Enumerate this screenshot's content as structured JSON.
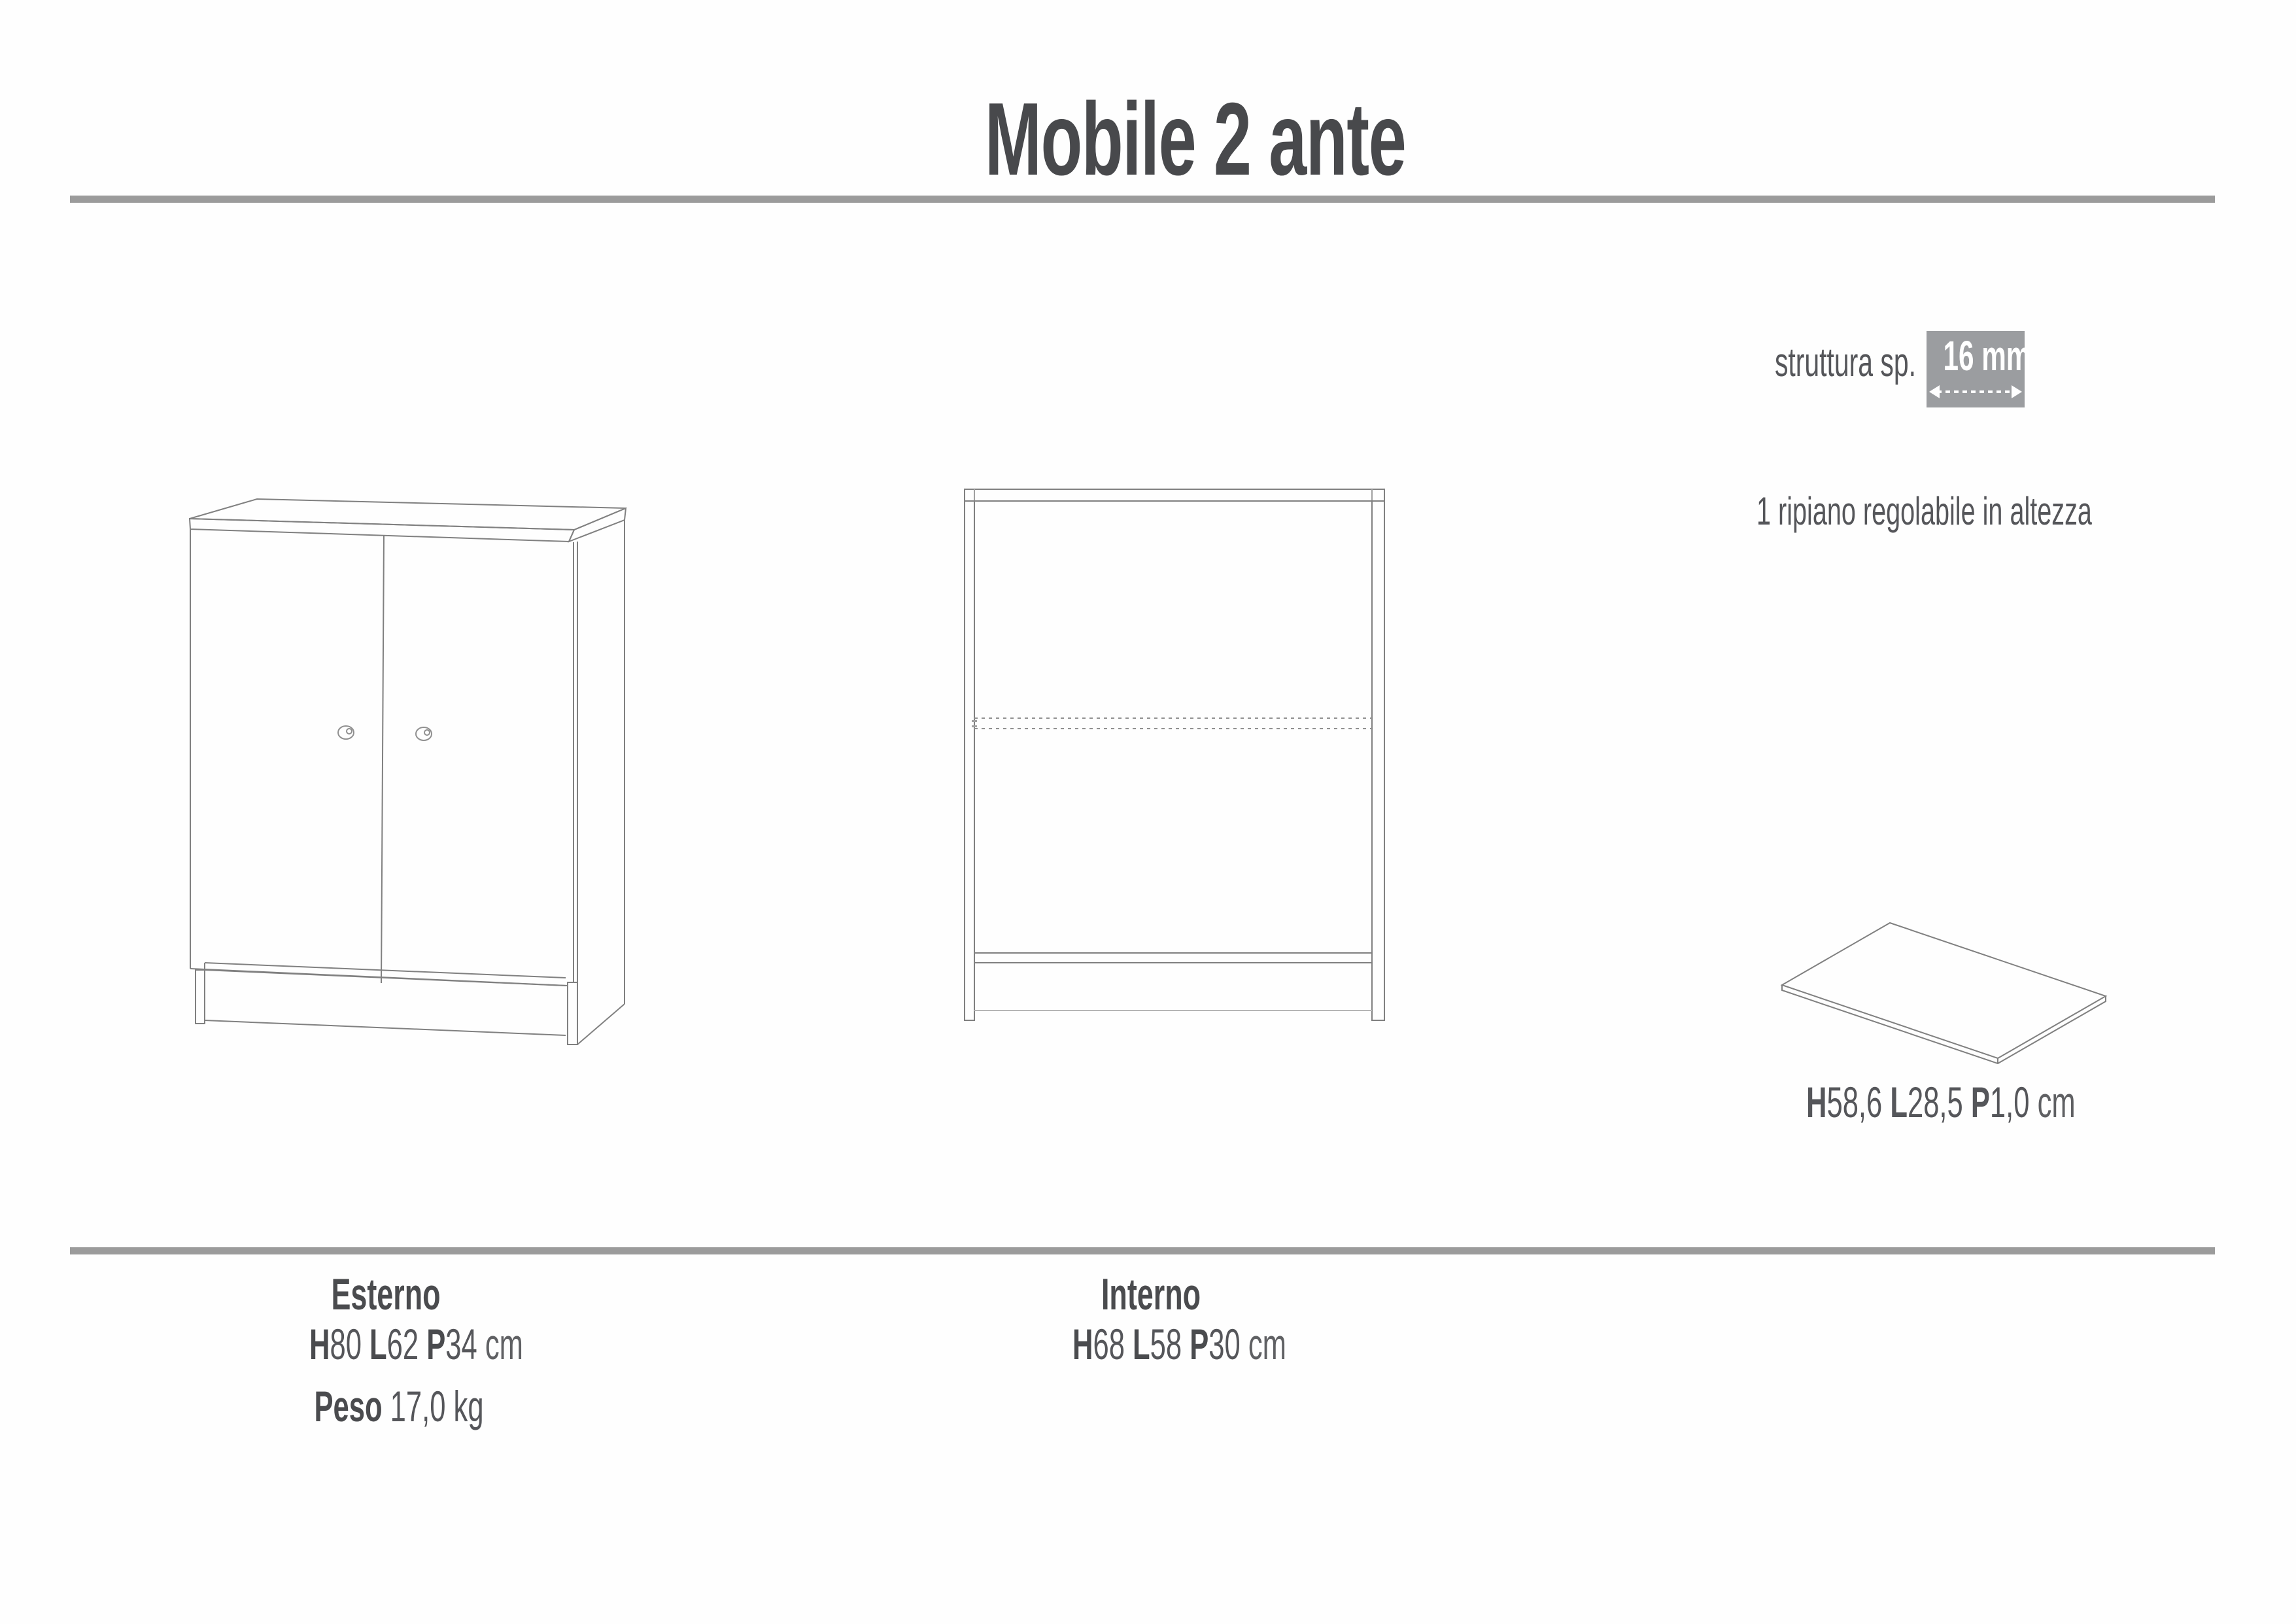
{
  "title": "Mobile 2 ante",
  "annotations": {
    "structure_label": "struttura sp.",
    "structure_value": "16 mm",
    "shelf_note": "1 ripiano regolabile in altezza"
  },
  "shelf": {
    "dims": [
      {
        "label": "H",
        "value": "58,6"
      },
      {
        "label": "L",
        "value": "28,5"
      },
      {
        "label": "P",
        "value": "1,0"
      }
    ],
    "unit": "cm"
  },
  "specs": {
    "external": {
      "heading": "Esterno",
      "dims": [
        {
          "label": "H",
          "value": "80"
        },
        {
          "label": "L",
          "value": "62"
        },
        {
          "label": "P",
          "value": "34"
        }
      ],
      "unit": "cm",
      "weight_label": "Peso",
      "weight_value": "17,0 kg"
    },
    "internal": {
      "heading": "Interno",
      "dims": [
        {
          "label": "H",
          "value": "68"
        },
        {
          "label": "L",
          "value": "58"
        },
        {
          "label": "P",
          "value": "30"
        }
      ],
      "unit": "cm"
    }
  },
  "colors": {
    "rule_gray": "#9b9b9b",
    "badge_gray": "#9b9da0",
    "title_gray": "#48494c",
    "text_gray": "#55565a",
    "line_gray": "#808080"
  }
}
